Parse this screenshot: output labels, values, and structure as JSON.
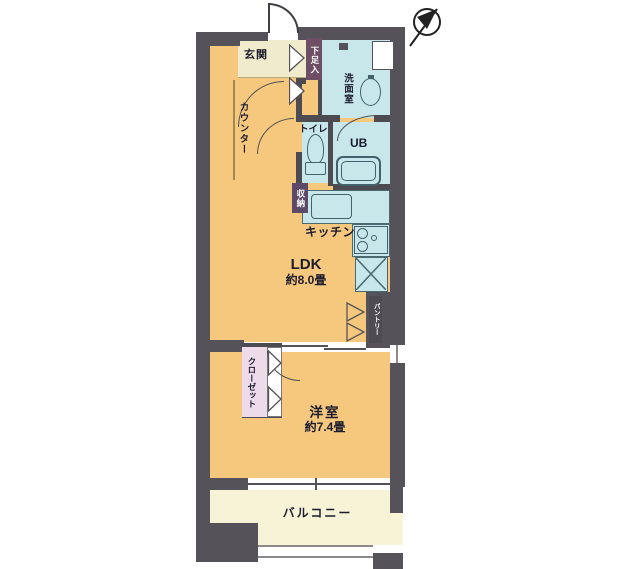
{
  "plan_type": "apartment-floor-plan",
  "compass": {
    "icon": "north-arrow"
  },
  "rooms": {
    "genkan": {
      "label": "玄関"
    },
    "shoebox": {
      "label": "下足入"
    },
    "washroom": {
      "label": "洗面室"
    },
    "toilet": {
      "label": "トイレ"
    },
    "unit_bath": {
      "label": "UB"
    },
    "storage": {
      "label": "収納"
    },
    "kitchen": {
      "label": "キッチン"
    },
    "ldk": {
      "label": "LDK",
      "size": "約8.0畳"
    },
    "counter": {
      "label": "カウンター"
    },
    "pantry": {
      "label": "パントリー"
    },
    "closet": {
      "label": "クローゼット"
    },
    "western_room": {
      "label": "洋室",
      "size": "約7.4畳"
    },
    "balcony": {
      "label": "バルコニー"
    }
  },
  "colors": {
    "wall": "#55525a",
    "living_floor": "#f5c87d",
    "wet_area_floor": "#c7e7ea",
    "entrance_floor": "#f1ebcd",
    "balcony_floor": "#f7f3d6",
    "closet_floor": "#eedbe9",
    "storage_label_bg": "#5c4a68",
    "shoebox_label_bg": "#6d4e63",
    "fixture_line": "#44606a"
  }
}
